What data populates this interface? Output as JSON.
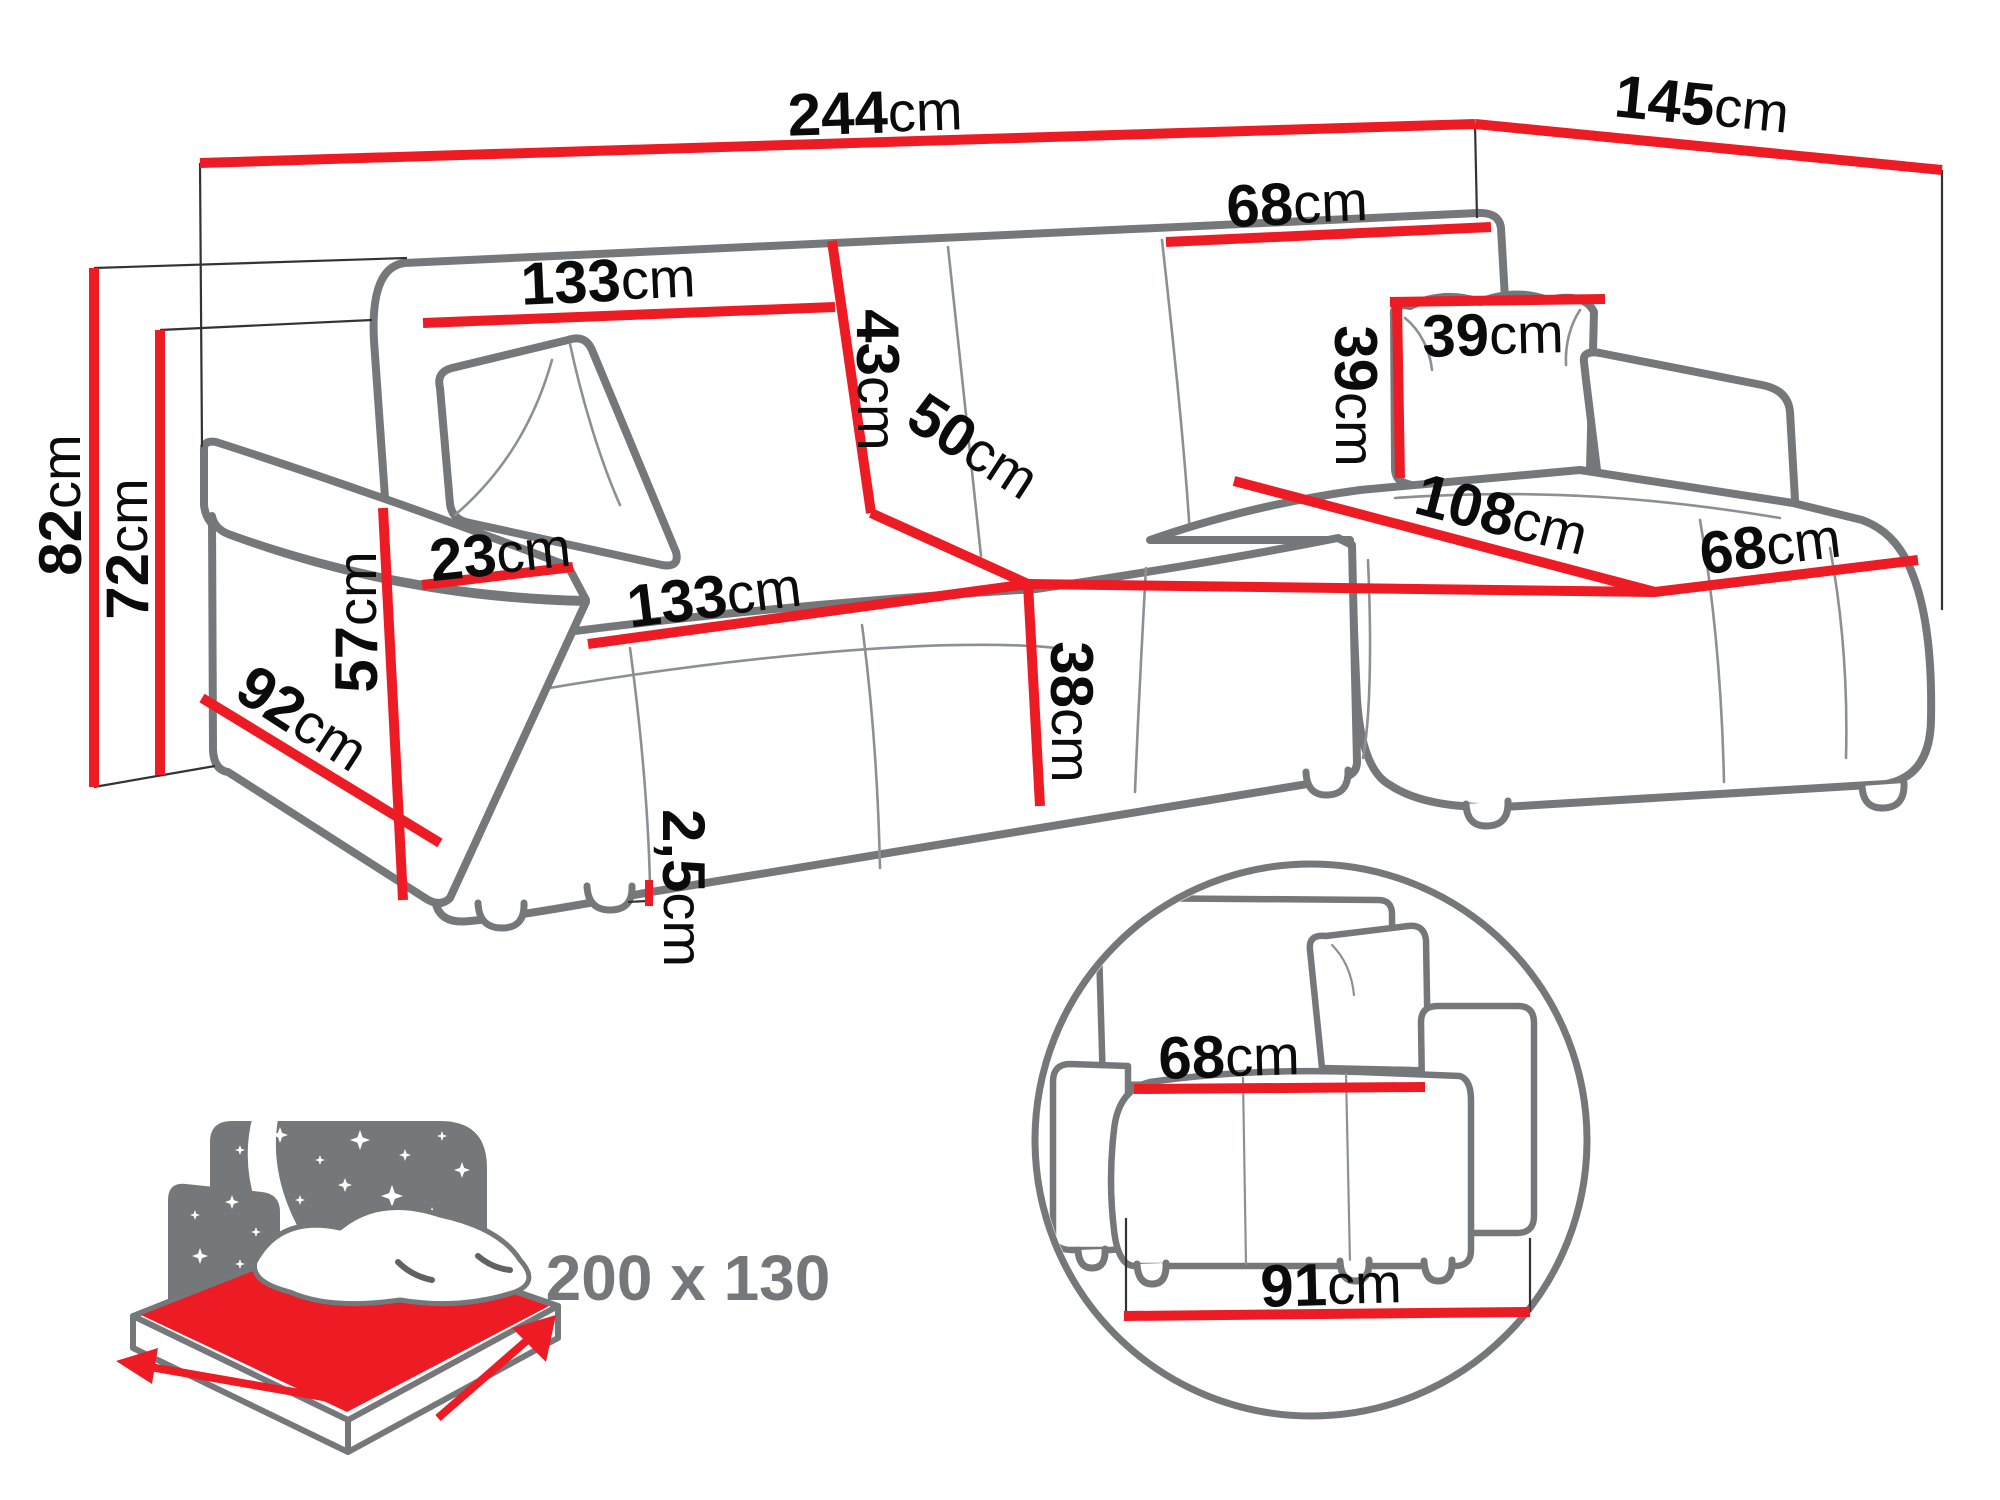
{
  "figure": {
    "type": "corner-sofa-dimension-diagram",
    "views": {
      "main": "perspective corner sofa with dimension lines",
      "detail_circle": "side cross-section of seat and armrest",
      "bed_icon": "sleeping function bed size icon"
    }
  },
  "colors": {
    "dimension_red": "#ed1c24",
    "outline_gray": "#75787b",
    "label_black": "#0b0b0b",
    "icon_gray": "#75787b",
    "background": "#ffffff"
  },
  "dims": {
    "width_total": {
      "num": "244",
      "unit": "cm"
    },
    "depth_total": {
      "num": "145",
      "unit": "cm"
    },
    "height_total": {
      "num": "82",
      "unit": "cm"
    },
    "height_backrest": {
      "num": "72",
      "unit": "cm"
    },
    "backrest_left_width": {
      "num": "133",
      "unit": "cm"
    },
    "backrest_height": {
      "num": "43",
      "unit": "cm"
    },
    "backrest_right_width": {
      "num": "68",
      "unit": "cm"
    },
    "pillow_height": {
      "num": "39",
      "unit": "cm"
    },
    "pillow_width": {
      "num": "39",
      "unit": "cm"
    },
    "seat_width": {
      "num": "133",
      "unit": "cm"
    },
    "seat_depth": {
      "num": "50",
      "unit": "cm"
    },
    "seat_height": {
      "num": "38",
      "unit": "cm"
    },
    "armrest_width": {
      "num": "23",
      "unit": "cm"
    },
    "armrest_height": {
      "num": "57",
      "unit": "cm"
    },
    "side_depth": {
      "num": "92",
      "unit": "cm"
    },
    "chaise_length": {
      "num": "108",
      "unit": "cm"
    },
    "chaise_width": {
      "num": "68",
      "unit": "cm"
    },
    "leg_height": {
      "num": "2,5",
      "unit": "cm"
    },
    "detail_seat_depth": {
      "num": "68",
      "unit": "cm"
    },
    "detail_total_depth": {
      "num": "91",
      "unit": "cm"
    },
    "bed_size": "200 x 130"
  }
}
